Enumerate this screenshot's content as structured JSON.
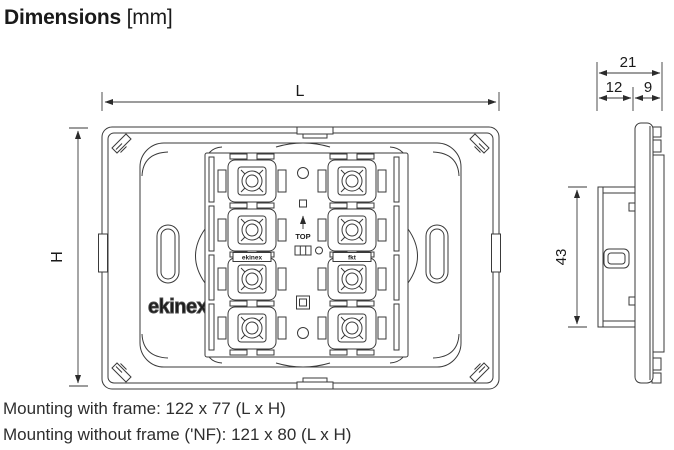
{
  "title": {
    "main": "Dimensions",
    "unit": "[mm]"
  },
  "front_view": {
    "length_label": "L",
    "height_label": "H",
    "orientation_marking": "TOP",
    "brand_logo": "ekinex",
    "module_label_left": "ekinex",
    "module_label_right": "fkt"
  },
  "side_view": {
    "total_depth": "21",
    "front_depth": "12",
    "back_depth": "9",
    "mechanism_height": "43"
  },
  "notes": [
    "Mounting with frame: 122 x 77 (L x H)",
    "Mounting without frame ('NF): 121 x 80 (L x H)"
  ],
  "colors": {
    "line": "#3a3a3a",
    "text": "#1a1a1a",
    "background": "#ffffff"
  }
}
